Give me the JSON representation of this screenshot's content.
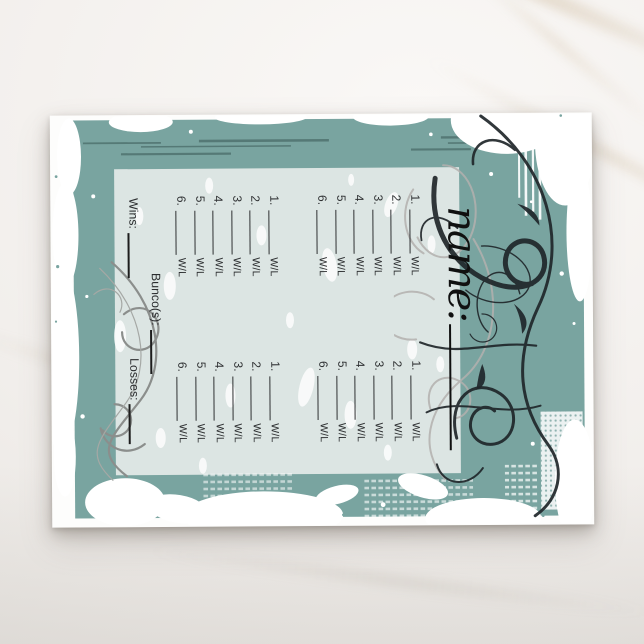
{
  "product": {
    "kind": "bunco-score-card-postcard",
    "note": "printed score card design rotated 90 degrees on a landscape postcard, photographed on marble"
  },
  "scorecard": {
    "name_label": "name:",
    "row_numbers": [
      "1.",
      "2.",
      "3.",
      "4.",
      "5.",
      "6."
    ],
    "win_loss_label": "W/L",
    "games_count": 4,
    "totals": {
      "wins_label": "Wins:",
      "bunco_label": "Bunco(s):",
      "losses_label": "Losses:"
    }
  },
  "colors": {
    "teal": "#79a4a0",
    "panel": "#dce5e3",
    "ink": "#2e3032",
    "script_ink": "#101010",
    "flourish_black": "#20262a",
    "flourish_grey_top": "#b3b1ae",
    "flourish_grey_bottom": "#8b8e8c",
    "card_white": "#fdfdfc",
    "marble": "#f2efec"
  }
}
